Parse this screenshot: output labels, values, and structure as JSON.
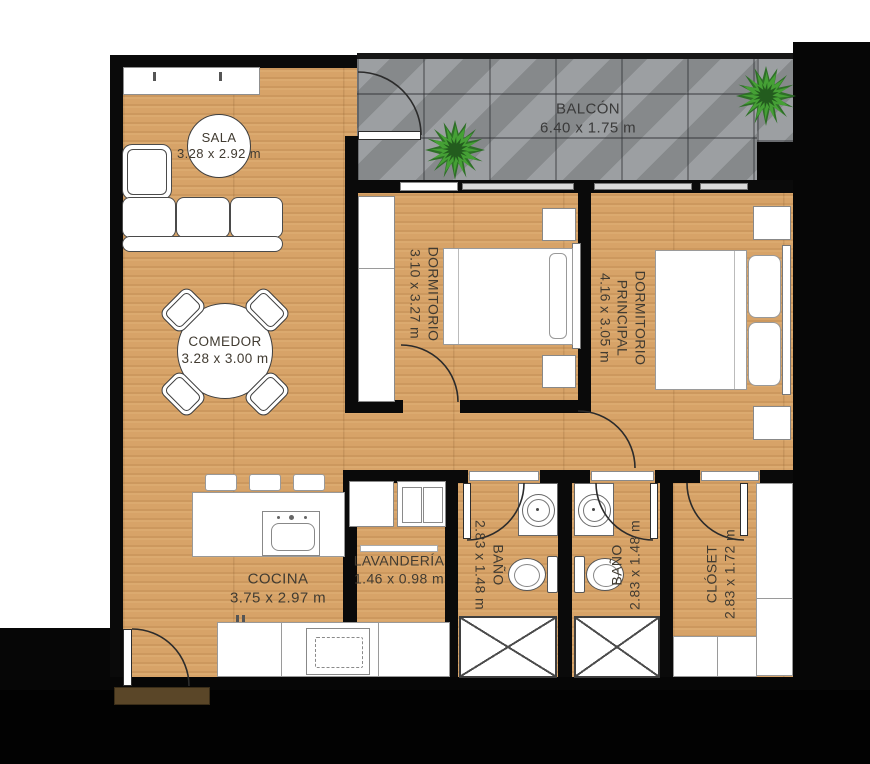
{
  "floorplan": {
    "rooms": {
      "sala": {
        "label": "SALA",
        "dims": "3.28 x 2.92 m"
      },
      "balcon": {
        "label": "BALCÓN",
        "dims": "6.40 x 1.75 m"
      },
      "dormitorio": {
        "label": "DORMITORIO",
        "dims": "3.10 x 3.27 m"
      },
      "dormitorio_principal": {
        "line1": "DORMITORIO",
        "line2": "PRINCIPAL",
        "dims": "4.16 x 3.05 m"
      },
      "comedor": {
        "label": "COMEDOR",
        "dims": "3.28 x 3.00 m"
      },
      "cocina": {
        "label": "COCINA",
        "dims": "3.75 x 2.97 m"
      },
      "lavanderia": {
        "label": "LAVANDERÍA",
        "dims": "1.46 x 0.98 m"
      },
      "bano_1": {
        "label": "BAÑO",
        "dims": "2.83 x 1.48 m"
      },
      "bano_2": {
        "label": "BAÑO",
        "dims": "2.83 x 1.48 m"
      },
      "closet": {
        "label": "CLÓSET",
        "dims": "2.83 x 1.72 m"
      }
    },
    "colors": {
      "wall": "#0a0a0a",
      "wood_floor": "#d7a368",
      "balcony_tile": "#95989b",
      "label_text": "#413b31",
      "furniture_fill": "#ffffff",
      "plant_green": "#45a035",
      "door_mat": "#5a4628"
    }
  }
}
